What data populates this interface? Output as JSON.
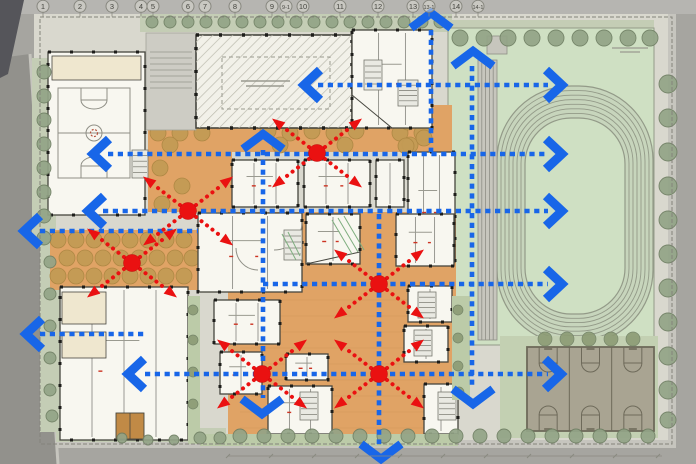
{
  "description": "Architectural campus site plan with circulation overlay: blue dotted bidirectional routes with chevron arrows and red evacuation nodes with radiating dotted arrows",
  "colors": {
    "road": "#a6a5a0",
    "road_dark": "#92918c",
    "corner_dark": "#55555a",
    "top_strip": "#b6b5b1",
    "sidewalk": "#c6c5be",
    "site": "#d9d8ce",
    "wall": "#84847b",
    "verge": "#c4cdb5",
    "tree_street": "#93a487",
    "tree_street_edge": "#6f7f63",
    "tree_olive": "#8c9b74",
    "field": "#cfe0c3",
    "track_band": "#c7d5bc",
    "track_line": "#939a88",
    "bleacher": "#c7c6bd",
    "bleacher_line": "#8e8e85",
    "courts": "#a9a492",
    "courts_line": "#6e6a5a",
    "courts_apron": "#c3d0b2",
    "orange": "#e0a365",
    "orange_line": "#c98e4e",
    "tan_tree": "#c39b55",
    "tan_tree_edge": "#ad8743",
    "white_bldg": "#f8f7f0",
    "wall_dark": "#46463f",
    "column": "#1d1d1a",
    "cream": "#efe7cf",
    "brown": "#c18a46",
    "plaza": "#cdccc4",
    "plaza_line": "#a3a39a",
    "hatch_bg": "#f2f1e9",
    "hatch_line": "#bcbaae",
    "stair": "#e9e9e2",
    "stair_line": "#77776e",
    "green_strip": "#bccba8",
    "green_hatch": "#7fae7f",
    "court_mark": "#8f8f86",
    "court_red": "#b3543f",
    "blue": "#1866e8",
    "red": "#ea1111",
    "bubble_fill": "#d8d7cf",
    "bubble_stroke": "#87877f",
    "bubble_text": "#45453f",
    "tick": "#8a8a80",
    "label_smudge": "#9a9a90",
    "red_mark": "#cc3322"
  },
  "grid_labels": [
    [
      "1",
      43
    ],
    [
      "2",
      80
    ],
    [
      "3",
      112
    ],
    [
      "4",
      141
    ],
    [
      "5",
      153
    ],
    [
      "6",
      188
    ],
    [
      "7",
      205
    ],
    [
      "8",
      235
    ],
    [
      "9",
      272
    ],
    [
      "9-1",
      286
    ],
    [
      "10",
      303
    ],
    [
      "11",
      340
    ],
    [
      "12",
      378
    ],
    [
      "13",
      413
    ],
    [
      "13-1",
      429
    ],
    [
      "14",
      456
    ],
    [
      "14-1",
      478
    ]
  ],
  "overlay": {
    "lines": [
      [
        318,
        85,
        548,
        85
      ],
      [
        108,
        154,
        548,
        154
      ],
      [
        103,
        211,
        548,
        211
      ],
      [
        40,
        231,
        198,
        231
      ],
      [
        263,
        284,
        548,
        284
      ],
      [
        40,
        334,
        145,
        334
      ],
      [
        145,
        374,
        548,
        374
      ],
      [
        263,
        150,
        263,
        398
      ],
      [
        379,
        214,
        379,
        444
      ],
      [
        431,
        30,
        431,
        152
      ],
      [
        472,
        66,
        472,
        388
      ]
    ],
    "chevrons": [
      [
        "l",
        98,
        154
      ],
      [
        "l",
        93,
        211
      ],
      [
        "l",
        29,
        231
      ],
      [
        "l",
        31,
        334
      ],
      [
        "l",
        133,
        374
      ],
      [
        "l",
        309,
        85
      ],
      [
        "r",
        557,
        85
      ],
      [
        "r",
        557,
        154
      ],
      [
        "r",
        557,
        211
      ],
      [
        "r",
        557,
        284
      ],
      [
        "r",
        556,
        374
      ],
      [
        "u",
        263,
        141
      ],
      [
        "u",
        431,
        20
      ],
      [
        "u",
        473,
        58
      ],
      [
        "d",
        262,
        407
      ],
      [
        "d",
        473,
        397
      ],
      [
        "d",
        381,
        452
      ]
    ],
    "nodes": [
      [
        317,
        153
      ],
      [
        188,
        211
      ],
      [
        132,
        263
      ],
      [
        379,
        284
      ],
      [
        262,
        374
      ],
      [
        379,
        374
      ]
    ],
    "arrow": {
      "dx": 34,
      "dy": 26,
      "head_l": 13,
      "head_w": 10
    }
  },
  "plan": {
    "site_rect": [
      34,
      14,
      642,
      434
    ],
    "roads": {
      "left_poly": "0,58 30,54 58,464 0,464",
      "corner_poly": "0,0 24,0 8,74 0,78",
      "bottom_walk": [
        58,
        440,
        618,
        8
      ],
      "right_walk": [
        668,
        14,
        8,
        434
      ]
    },
    "wall_rect": [
      40,
      17,
      632,
      427
    ],
    "verges": [
      [
        140,
        14,
        312,
        18
      ],
      [
        448,
        20,
        206,
        42
      ],
      [
        32,
        58,
        24,
        182
      ],
      [
        40,
        242,
        20,
        190
      ],
      [
        56,
        428,
        170,
        14
      ]
    ],
    "verge_ellipse": [
      76,
      434,
      16,
      7
    ],
    "street_trees": [
      [
        152,
        22,
        6
      ],
      [
        170,
        22,
        6
      ],
      [
        188,
        22,
        6
      ],
      [
        206,
        22,
        6
      ],
      [
        224,
        22,
        6
      ],
      [
        242,
        22,
        6
      ],
      [
        260,
        22,
        6
      ],
      [
        278,
        22,
        6
      ],
      [
        296,
        22,
        6
      ],
      [
        314,
        22,
        6
      ],
      [
        332,
        22,
        6
      ],
      [
        350,
        22,
        6
      ],
      [
        368,
        22,
        6
      ],
      [
        386,
        22,
        6
      ],
      [
        404,
        22,
        6
      ],
      [
        422,
        22,
        6
      ],
      [
        440,
        22,
        6
      ],
      [
        460,
        38,
        8
      ],
      [
        484,
        38,
        8
      ],
      [
        508,
        38,
        8
      ],
      [
        532,
        38,
        8
      ],
      [
        556,
        38,
        8
      ],
      [
        580,
        38,
        8
      ],
      [
        604,
        38,
        8
      ],
      [
        628,
        38,
        8
      ],
      [
        650,
        38,
        8
      ],
      [
        668,
        84,
        9
      ],
      [
        668,
        118,
        9
      ],
      [
        668,
        152,
        9
      ],
      [
        668,
        186,
        9
      ],
      [
        668,
        220,
        9
      ],
      [
        668,
        254,
        9
      ],
      [
        668,
        288,
        9
      ],
      [
        668,
        322,
        9
      ],
      [
        668,
        356,
        9
      ],
      [
        668,
        390,
        9
      ],
      [
        668,
        420,
        8
      ],
      [
        240,
        436,
        7
      ],
      [
        264,
        436,
        7
      ],
      [
        288,
        436,
        7
      ],
      [
        312,
        436,
        7
      ],
      [
        336,
        436,
        7
      ],
      [
        360,
        436,
        7
      ],
      [
        384,
        436,
        7
      ],
      [
        408,
        436,
        7
      ],
      [
        432,
        436,
        7
      ],
      [
        456,
        436,
        7
      ],
      [
        480,
        436,
        7
      ],
      [
        504,
        436,
        7
      ],
      [
        528,
        436,
        7
      ],
      [
        552,
        436,
        7
      ],
      [
        576,
        436,
        7
      ],
      [
        600,
        436,
        7
      ],
      [
        624,
        436,
        7
      ],
      [
        648,
        436,
        7
      ],
      [
        200,
        438,
        6
      ],
      [
        220,
        438,
        6
      ],
      [
        122,
        438,
        5
      ],
      [
        148,
        440,
        5
      ],
      [
        174,
        440,
        5
      ],
      [
        44,
        72,
        7
      ],
      [
        44,
        96,
        7
      ],
      [
        44,
        120,
        7
      ],
      [
        44,
        144,
        7
      ],
      [
        44,
        168,
        7
      ],
      [
        44,
        192,
        7
      ],
      [
        44,
        216,
        7
      ],
      [
        44,
        238,
        7
      ],
      [
        50,
        262,
        6
      ],
      [
        50,
        294,
        6
      ],
      [
        50,
        326,
        6
      ],
      [
        50,
        358,
        6
      ],
      [
        50,
        390,
        6
      ],
      [
        52,
        416,
        6
      ]
    ],
    "olive_trees": [
      [
        545,
        339,
        7
      ],
      [
        567,
        339,
        7
      ],
      [
        589,
        339,
        7
      ],
      [
        611,
        339,
        7
      ],
      [
        633,
        339,
        7
      ],
      [
        193,
        310,
        5
      ],
      [
        193,
        340,
        5
      ],
      [
        193,
        372,
        5
      ],
      [
        193,
        404,
        5
      ],
      [
        458,
        310,
        5
      ],
      [
        458,
        338,
        5
      ],
      [
        458,
        366,
        5
      ],
      [
        459,
        392,
        5
      ]
    ],
    "orange_rects": [
      [
        148,
        118,
        84,
        94
      ],
      [
        232,
        118,
        198,
        34
      ],
      [
        50,
        230,
        148,
        60
      ],
      [
        228,
        212,
        228,
        228
      ],
      [
        400,
        105,
        52,
        47
      ]
    ],
    "orange_poly": "62,392 145,392 145,440 80,440 62,424",
    "tan_tree_r": 8,
    "tan_trees": [
      [
        158,
        133
      ],
      [
        180,
        133
      ],
      [
        202,
        133
      ],
      [
        268,
        131
      ],
      [
        290,
        133
      ],
      [
        312,
        131
      ],
      [
        334,
        133
      ],
      [
        356,
        131
      ],
      [
        400,
        133
      ],
      [
        422,
        133
      ],
      [
        170,
        145
      ],
      [
        280,
        145
      ],
      [
        345,
        145
      ],
      [
        410,
        145
      ],
      [
        160,
        168
      ],
      [
        182,
        186
      ],
      [
        162,
        204
      ],
      [
        408,
        122
      ],
      [
        424,
        138
      ],
      [
        406,
        146
      ],
      [
        58,
        240
      ],
      [
        76,
        240
      ],
      [
        94,
        240
      ],
      [
        112,
        240
      ],
      [
        130,
        240
      ],
      [
        148,
        240
      ],
      [
        166,
        240
      ],
      [
        184,
        240
      ],
      [
        67,
        258
      ],
      [
        85,
        258
      ],
      [
        103,
        258
      ],
      [
        121,
        258
      ],
      [
        139,
        258
      ],
      [
        157,
        258
      ],
      [
        175,
        258
      ],
      [
        192,
        258
      ],
      [
        58,
        276
      ],
      [
        76,
        276
      ],
      [
        94,
        276
      ],
      [
        112,
        276
      ],
      [
        130,
        276
      ],
      [
        148,
        276
      ],
      [
        166,
        276
      ],
      [
        184,
        276
      ],
      [
        72,
        400
      ],
      [
        92,
        404
      ],
      [
        78,
        418
      ],
      [
        98,
        422
      ],
      [
        72,
        432
      ]
    ],
    "plaza": [
      146,
      33,
      50,
      97
    ],
    "plaza_step_ys": [
      52,
      58,
      64,
      70,
      76,
      82,
      88
    ],
    "hall": {
      "rect": [
        196,
        35,
        156,
        93
      ],
      "inner": [
        222,
        57,
        108,
        52
      ],
      "label_lines": [
        [
          241,
          81,
          290,
          81
        ],
        [
          246,
          86,
          284,
          86
        ]
      ]
    },
    "white_blocks": [
      [
        48,
        52,
        97,
        163,
        0
      ],
      [
        352,
        30,
        80,
        98,
        2
      ],
      [
        408,
        152,
        47,
        110,
        2
      ],
      [
        232,
        160,
        66,
        47,
        2
      ],
      [
        304,
        160,
        66,
        47,
        2
      ],
      [
        376,
        160,
        28,
        47,
        1
      ],
      [
        198,
        213,
        104,
        79,
        2
      ],
      [
        306,
        214,
        54,
        50,
        1
      ],
      [
        396,
        214,
        58,
        52,
        2
      ],
      [
        60,
        287,
        128,
        153,
        3
      ],
      [
        214,
        300,
        66,
        44,
        2
      ],
      [
        220,
        352,
        42,
        42,
        1
      ],
      [
        286,
        354,
        42,
        26,
        1
      ],
      [
        408,
        286,
        44,
        36,
        1
      ],
      [
        404,
        326,
        44,
        36,
        1
      ],
      [
        268,
        386,
        64,
        48,
        2
      ],
      [
        424,
        384,
        34,
        50,
        1
      ]
    ],
    "cream_rects": [
      [
        52,
        56,
        89,
        24
      ],
      [
        62,
        292,
        44,
        32
      ],
      [
        62,
        332,
        44,
        26
      ]
    ],
    "brown_rects": [
      [
        116,
        413,
        28,
        26
      ]
    ],
    "stairs": [
      [
        132,
        150,
        16,
        28
      ],
      [
        284,
        230,
        18,
        30
      ],
      [
        418,
        292,
        18,
        26
      ],
      [
        414,
        330,
        18,
        26
      ],
      [
        300,
        392,
        18,
        28
      ],
      [
        438,
        392,
        18,
        28
      ],
      [
        364,
        60,
        18,
        30
      ],
      [
        398,
        80,
        20,
        26
      ]
    ],
    "diag_walls": [
      [
        352,
        95,
        392,
        128
      ],
      [
        306,
        264,
        360,
        252
      ]
    ],
    "curved_walls": [
      "M302,222 a28,28 0 0 1 -28,28",
      "M236,248 a22,22 0 0 0 22,22"
    ],
    "green_strips": [
      [
        188,
        296,
        12,
        148
      ],
      [
        452,
        296,
        18,
        104
      ],
      [
        200,
        434,
        258,
        12
      ]
    ],
    "green_hatch_lines": [
      [
        332,
        220,
        352,
        254
      ],
      [
        338,
        218,
        358,
        252
      ],
      [
        344,
        216,
        364,
        250
      ],
      [
        282,
        234,
        296,
        260
      ],
      [
        288,
        232,
        300,
        256
      ]
    ],
    "gym_court": [
      58,
      88,
      72,
      90
    ],
    "track": {
      "field": [
        448,
        28,
        206,
        317
      ],
      "outer": [
        497,
        86,
        156,
        258,
        74
      ],
      "inner": [
        525,
        118,
        100,
        196,
        46
      ],
      "lanes": 6,
      "bleachers": [
        478,
        60,
        19,
        280
      ],
      "bleacher_lines": 4,
      "stair_top": [
        487,
        36,
        20,
        18
      ],
      "label_lines": [
        [
          612,
          48,
          648,
          48
        ],
        [
          620,
          52,
          640,
          52
        ]
      ]
    },
    "courts": {
      "rect": [
        527,
        347,
        127,
        84
      ],
      "apron": [
        500,
        336,
        158,
        102
      ],
      "cols": 3,
      "key_w": 18,
      "key_h": 16,
      "arc_r": 9
    },
    "dim_bottom": {
      "y": 456,
      "x1": 228,
      "x2": 662,
      "step": 43
    }
  }
}
